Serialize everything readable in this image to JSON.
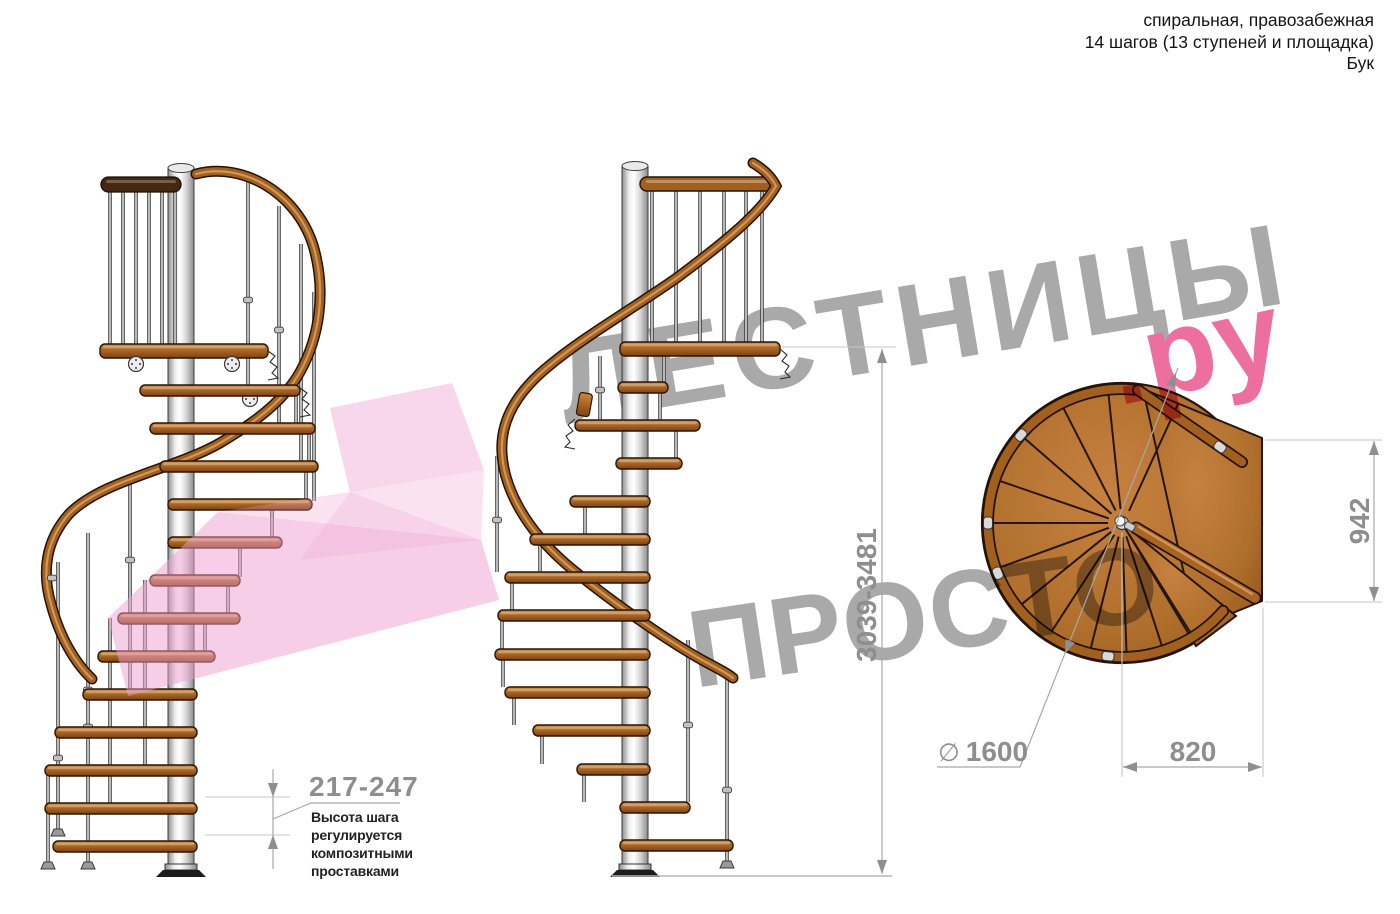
{
  "header": {
    "line1": "спиральная, правозабежная",
    "line2": "14 шагов (13 ступеней и площадка)",
    "line3": "Бук"
  },
  "watermark": {
    "line1": "ЛЕСТНИЦЫ",
    "line2": "ПРОСТО",
    "suffix": ".ру",
    "gray_color": "#a9a9a9",
    "pink_color": "#ec6f9f"
  },
  "dimensions": {
    "step_height": "217-247",
    "total_height": "3039-3481",
    "platform_width": "942",
    "platform_depth": "820",
    "diameter_symbol": "∅",
    "diameter_value": "1600"
  },
  "note": {
    "line1": "Высота шага",
    "line2": "регулируется",
    "line3": "композитными",
    "line4": "проставками"
  },
  "colors": {
    "wood": "#b06f2c",
    "wood_dark": "#7d4312",
    "rail": "#a2601f",
    "metal": "#c9c9c9",
    "dimension_gray": "#8e8e8e",
    "pink_arrow": "#ef9ed0"
  }
}
